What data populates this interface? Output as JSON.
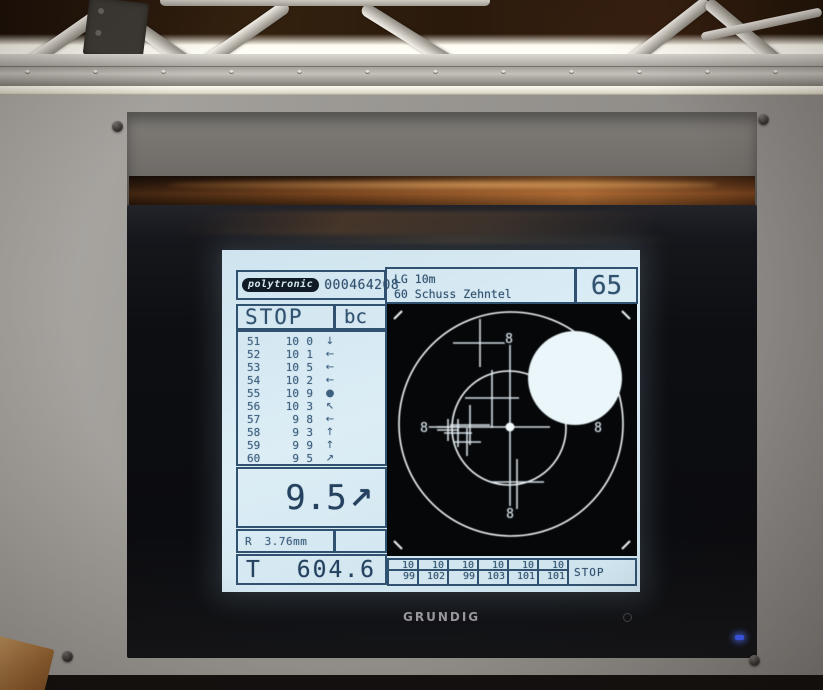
{
  "scene": {
    "brand": "GRUNDIG",
    "power_led_color": "#3e5eff"
  },
  "screen": {
    "bg_color": "#d7e9f2",
    "ink_color": "#30516f",
    "header": {
      "logo_text": "polytronic",
      "serial": "000464208",
      "title_line1": "LG 10m",
      "title_line2": "60 Schuss Zehntel",
      "lane": "65"
    },
    "status": {
      "left": "STOP",
      "right": "bc"
    },
    "shots": [
      {
        "no": "51",
        "score": "10",
        "tenth": "0",
        "dir": "↓"
      },
      {
        "no": "52",
        "score": "10",
        "tenth": "1",
        "dir": "←"
      },
      {
        "no": "53",
        "score": "10",
        "tenth": "5",
        "dir": "←"
      },
      {
        "no": "54",
        "score": "10",
        "tenth": "2",
        "dir": "←"
      },
      {
        "no": "55",
        "score": "10",
        "tenth": "9",
        "dir": "●"
      },
      {
        "no": "56",
        "score": "10",
        "tenth": "3",
        "dir": "↖"
      },
      {
        "no": "57",
        "score": "9",
        "tenth": "8",
        "dir": "←"
      },
      {
        "no": "58",
        "score": "9",
        "tenth": "3",
        "dir": "↑"
      },
      {
        "no": "59",
        "score": "9",
        "tenth": "9",
        "dir": "↑"
      },
      {
        "no": "60",
        "score": "9",
        "tenth": "5",
        "dir": "↗"
      }
    ],
    "current": {
      "value": "9.5",
      "dir": "↗"
    },
    "radius": {
      "label": "R",
      "value": "3.76mm"
    },
    "total": {
      "label": "T",
      "value": "604.6"
    },
    "series": {
      "columns": [
        {
          "top": "10",
          "bottom": "99"
        },
        {
          "top": "10",
          "bottom": "102"
        },
        {
          "top": "10",
          "bottom": "99"
        },
        {
          "top": "10",
          "bottom": "103"
        },
        {
          "top": "10",
          "bottom": "101"
        },
        {
          "top": "10",
          "bottom": "101"
        }
      ],
      "stop": "STOP"
    },
    "target": {
      "viewbox_w": 250,
      "viewbox_h": 252,
      "ring_color": "#eef5f8",
      "mark_color": "#dfeaf0",
      "circles": [
        {
          "cx": 124,
          "cy": 120,
          "r": 112
        },
        {
          "cx": 122,
          "cy": 124,
          "r": 57
        }
      ],
      "disc": {
        "cx": 188,
        "cy": 74,
        "r": 47
      },
      "center_dot": {
        "cx": 123,
        "cy": 123,
        "r": 4.5
      },
      "ring_labels": [
        {
          "text": "8",
          "x": 122,
          "y": 39
        },
        {
          "text": "8",
          "x": 37,
          "y": 128
        },
        {
          "text": "8",
          "x": 211,
          "y": 128
        },
        {
          "text": "8",
          "x": 123,
          "y": 214
        }
      ],
      "corner_ticks": [
        {
          "x1": 7,
          "y1": 15,
          "x2": 15,
          "y2": 7
        },
        {
          "x1": 235,
          "y1": 7,
          "x2": 243,
          "y2": 15
        },
        {
          "x1": 7,
          "y1": 237,
          "x2": 15,
          "y2": 245
        },
        {
          "x1": 235,
          "y1": 245,
          "x2": 243,
          "y2": 237
        }
      ],
      "shot_marks": [
        {
          "x1": 123,
          "y1": 40,
          "x2": 123,
          "y2": 203
        },
        {
          "x1": 50,
          "y1": 123,
          "x2": 163,
          "y2": 123
        },
        {
          "x1": 93,
          "y1": 15,
          "x2": 93,
          "y2": 63
        },
        {
          "x1": 66,
          "y1": 39,
          "x2": 120,
          "y2": 39
        },
        {
          "x1": 105,
          "y1": 66,
          "x2": 105,
          "y2": 124
        },
        {
          "x1": 78,
          "y1": 94,
          "x2": 132,
          "y2": 94
        },
        {
          "x1": 83,
          "y1": 101,
          "x2": 83,
          "y2": 141
        },
        {
          "x1": 63,
          "y1": 121,
          "x2": 103,
          "y2": 121
        },
        {
          "x1": 61,
          "y1": 115,
          "x2": 61,
          "y2": 137
        },
        {
          "x1": 50,
          "y1": 126,
          "x2": 72,
          "y2": 126
        },
        {
          "x1": 71,
          "y1": 115,
          "x2": 71,
          "y2": 143
        },
        {
          "x1": 57,
          "y1": 129,
          "x2": 85,
          "y2": 129
        },
        {
          "x1": 80,
          "y1": 124,
          "x2": 80,
          "y2": 152
        },
        {
          "x1": 66,
          "y1": 138,
          "x2": 94,
          "y2": 138
        },
        {
          "x1": 33,
          "y1": 123,
          "x2": 73,
          "y2": 123
        },
        {
          "x1": 130,
          "y1": 155,
          "x2": 130,
          "y2": 205
        },
        {
          "x1": 103,
          "y1": 178,
          "x2": 157,
          "y2": 178
        }
      ]
    }
  }
}
